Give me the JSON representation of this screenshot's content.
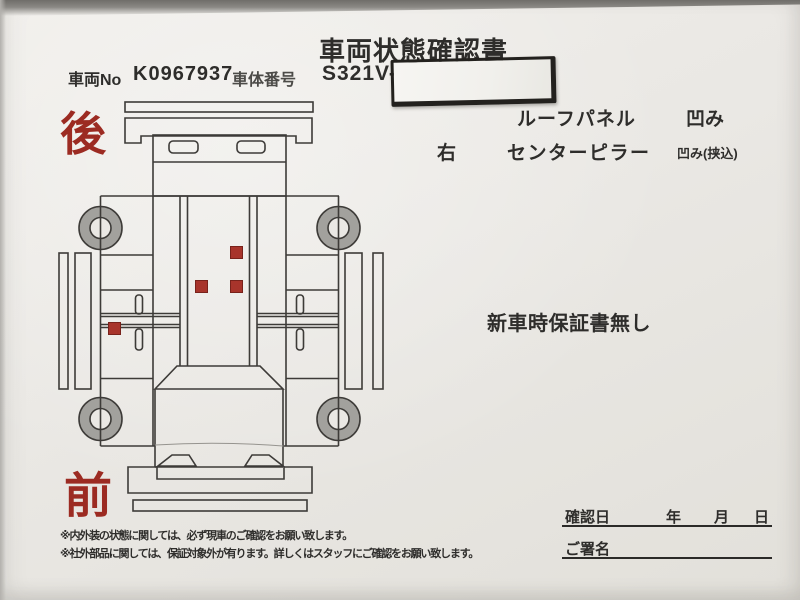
{
  "header": {
    "title": "車両状態確認書",
    "vehicle_no_label": "車両No",
    "vehicle_no_value": "K0967937",
    "body_no_label": "車体番号",
    "body_no_value_prefix": "S321V-",
    "body_no_redacted": true
  },
  "damage_report": {
    "rows": [
      {
        "position": "",
        "part": "ルーフパネル",
        "condition": "凹み"
      },
      {
        "position": "右",
        "part": "センターピラー",
        "condition": "凹み(挟込)"
      }
    ],
    "warranty_note": "新車時保証書無し"
  },
  "diagram": {
    "rear_label": "後",
    "front_label": "前",
    "damage_marks": [
      {
        "x": 235,
        "y": 251
      },
      {
        "x": 200,
        "y": 285
      },
      {
        "x": 235,
        "y": 285
      },
      {
        "x": 113,
        "y": 327
      }
    ]
  },
  "footer": {
    "notes": [
      "※内外装の状態に関しては、必ず現車のご確認をお願い致します。",
      "※社外部品に関しては、保証対象外が有ります。詳しくはスタッフにご確認をお願い致します。"
    ],
    "confirm": {
      "date_label": "確認日",
      "year_label": "年",
      "month_label": "月",
      "day_label": "日",
      "signature_label": "ご署名"
    }
  },
  "colors": {
    "accent_red": "#9c2b22",
    "damage_mark": "#a8342b",
    "ink": "#2e2d2b",
    "paper": "#eae8e4"
  }
}
